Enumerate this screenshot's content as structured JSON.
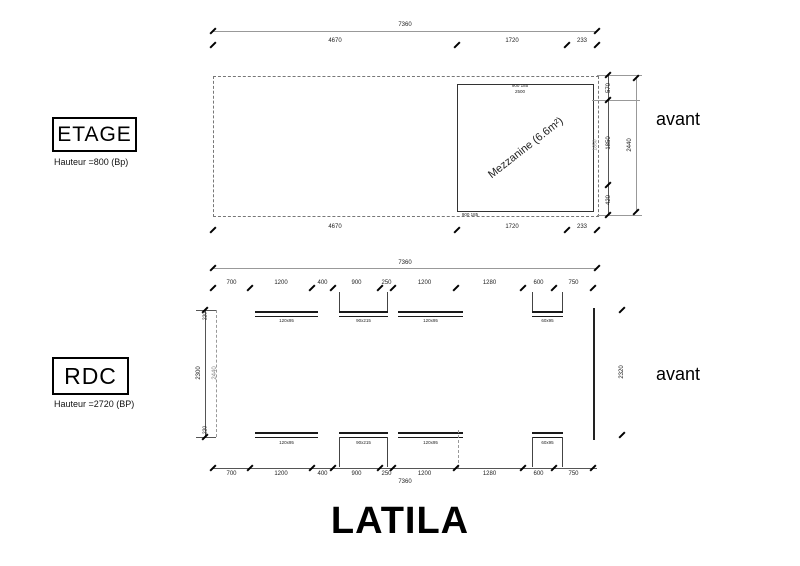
{
  "title": "LATILA",
  "etage": {
    "label": "ETAGE",
    "subtitle": "Hauteur =800 (Bp)",
    "side_label": "avant",
    "mezzanine": {
      "label": "Mezzanine (6.6m²)",
      "top_note_line1": "900 185",
      "top_note_line2": "2500",
      "bottom_note": "900 185",
      "inner_height": "1850"
    },
    "dims": {
      "total_width": "7360",
      "top_segments": [
        "4670",
        "1720",
        "233"
      ],
      "bottom_segments": [
        "4670",
        "1720",
        "233"
      ],
      "right_segments": [
        "570",
        "1850",
        "420"
      ],
      "right_total": "2440"
    }
  },
  "rdc": {
    "label": "RDC",
    "subtitle": "Hauteur =2720 (BP)",
    "side_label": "avant",
    "dims": {
      "total_width_top": "7360",
      "total_width_bottom": "7360",
      "top_segments": [
        "700",
        "1200",
        "400",
        "900",
        "250",
        "1200",
        "1280",
        "600",
        "750"
      ],
      "bottom_segments": [
        "700",
        "1200",
        "400",
        "900",
        "250",
        "1200",
        "1280",
        "600",
        "750"
      ],
      "left_outer": "2300",
      "left_edge_top": "220",
      "left_edge_bottom": "220",
      "left_inner": "2440",
      "right": "2320"
    },
    "openings_top": [
      {
        "code": "120x95"
      },
      {
        "code": "90x215"
      },
      {
        "code": "120x95"
      },
      {
        "code": "60x95"
      }
    ],
    "openings_bottom": [
      {
        "code": "120x95"
      },
      {
        "code": "90x215"
      },
      {
        "code": "120x95"
      },
      {
        "code": "60x95"
      }
    ]
  }
}
